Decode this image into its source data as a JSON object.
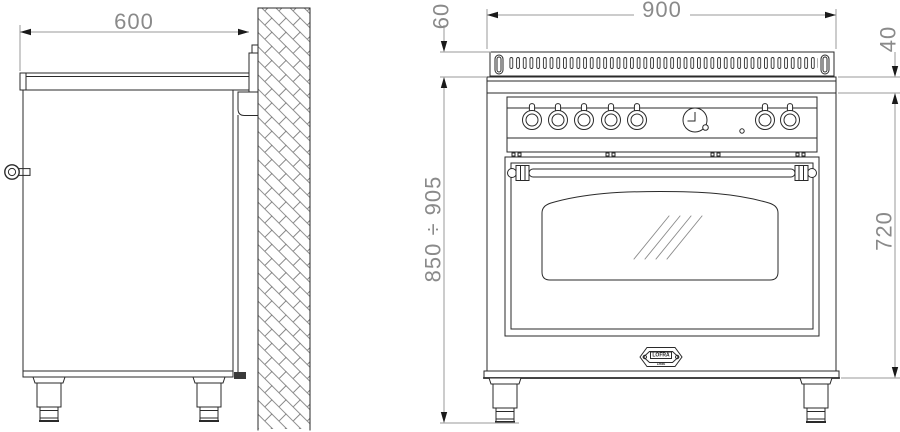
{
  "drawing": {
    "type": "technical-dimension-drawing",
    "subject": "range cooker, side view against wall and front view"
  },
  "dimensions": {
    "side_depth": "600",
    "front_width": "900",
    "backguard_height": "60",
    "top_trim_height": "40",
    "body_front_height": "720",
    "floor_to_worktop_range": "850 ÷ 905"
  },
  "badge": {
    "brand": "LOFRA",
    "year": "1956"
  },
  "colors": {
    "object_line": "#2a2a2a",
    "dimension_line": "#9a9a9a",
    "dimension_text": "#8a8a8a",
    "arrow": "#1a1a1a",
    "background": "#ffffff"
  }
}
